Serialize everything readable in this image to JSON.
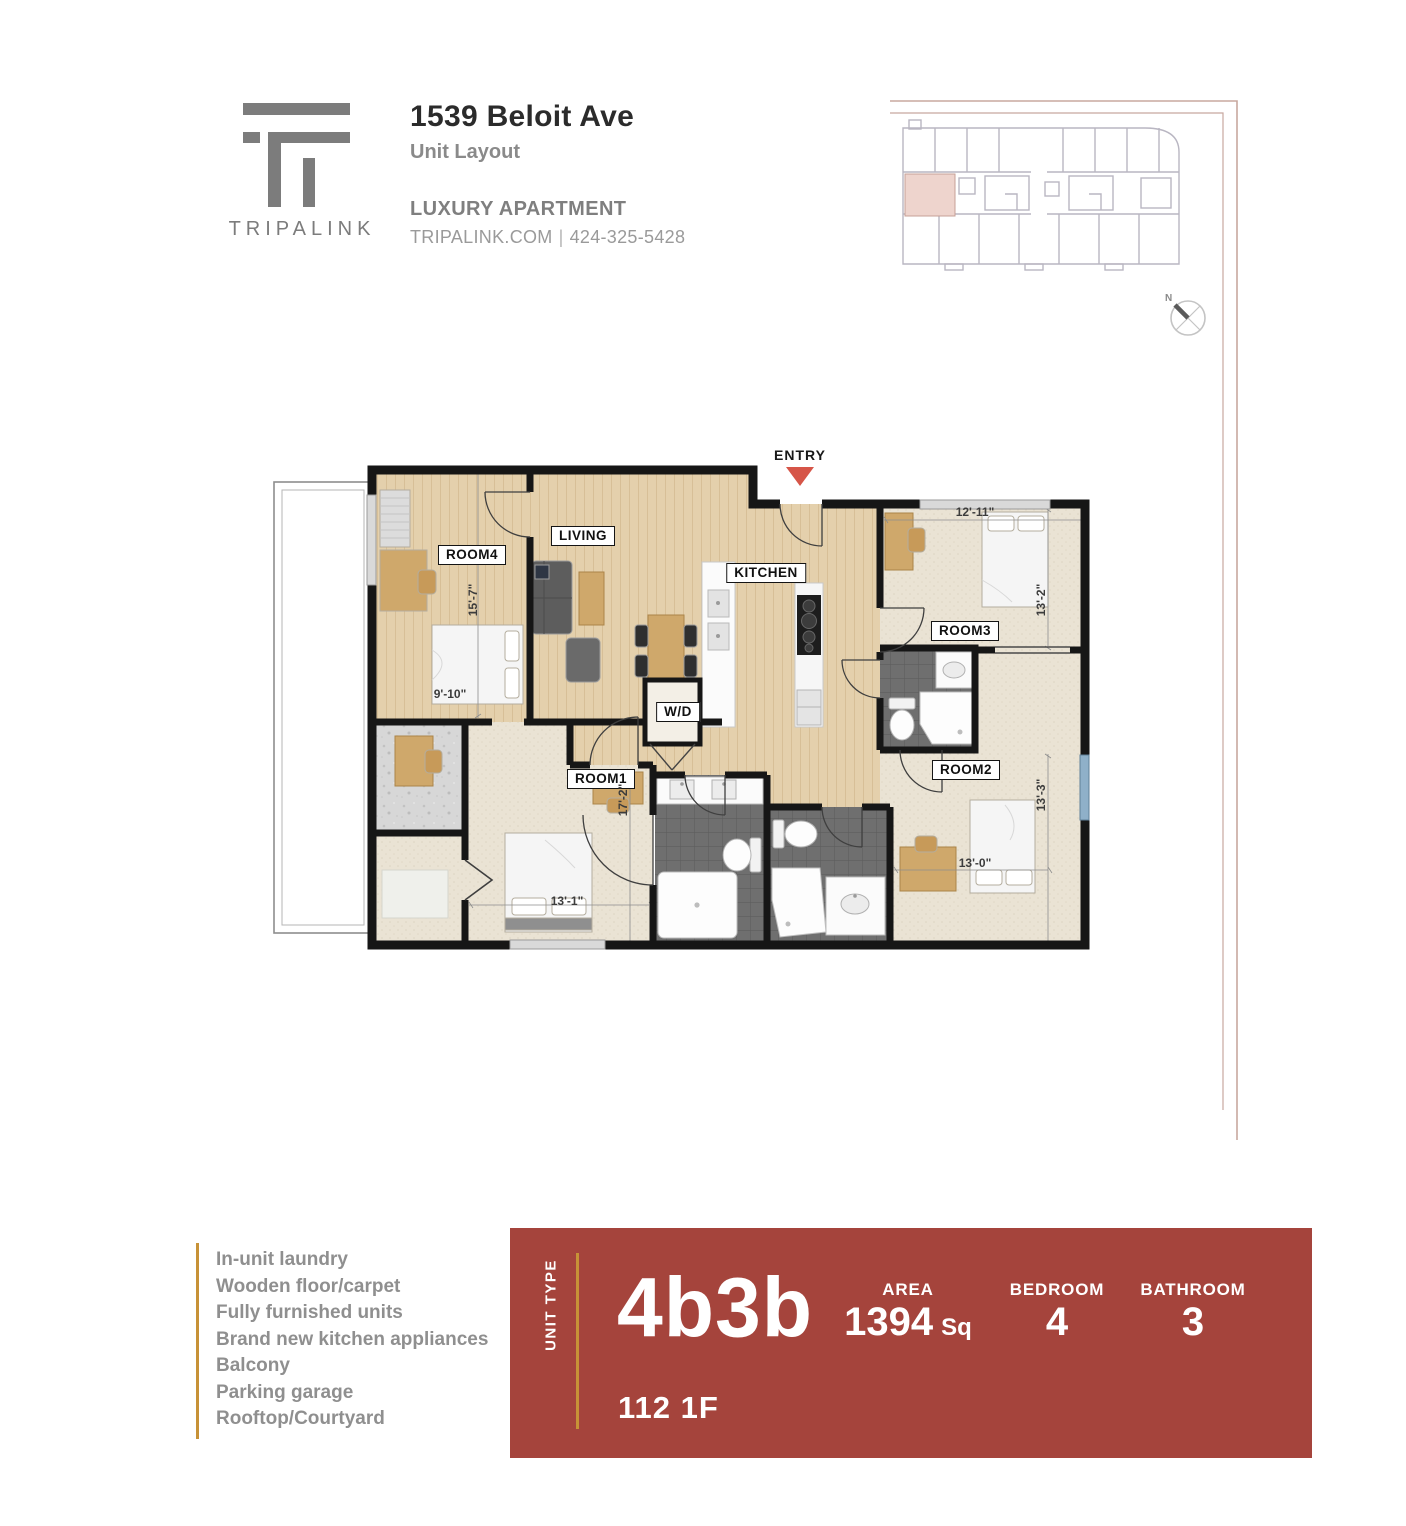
{
  "header": {
    "logo_text": "TRIPALINK",
    "address": "1539 Beloit Ave",
    "subtitle": "Unit Layout",
    "tagline": "LUXURY APARTMENT",
    "website": "TRIPALINK.COM",
    "contact_separator": "|",
    "phone": "424-325-5428"
  },
  "key_plan": {
    "north_label": "N"
  },
  "floor_plan": {
    "entry_label": "ENTRY",
    "labels": {
      "room1": "ROOM1",
      "room2": "ROOM2",
      "room3": "ROOM3",
      "room4": "ROOM4",
      "living": "LIVING",
      "kitchen": "KITCHEN",
      "washer_dryer": "W/D"
    },
    "dims": {
      "room4_v": "15'-7\"",
      "room4_h": "9'-10\"",
      "room3_h": "12'-11\"",
      "room3_v": "13'-2\"",
      "room2_v": "13'-3\"",
      "room2_h": "13'-0\"",
      "room1_v": "17'-2\"",
      "room1_h": "13'-1\""
    }
  },
  "amenities": [
    "In-unit laundry",
    "Wooden floor/carpet",
    "Fully furnished units",
    "Brand new kitchen appliances",
    "Balcony",
    "Parking garage",
    "Rooftop/Courtyard"
  ],
  "banner": {
    "unit_type_label": "UNIT TYPE",
    "unit_type": "4b3b",
    "unit_number": "112 1F",
    "stats": [
      {
        "label": "AREA",
        "value": "1394",
        "suffix": "Sq"
      },
      {
        "label": "BEDROOM",
        "value": "4",
        "suffix": ""
      },
      {
        "label": "BATHROOM",
        "value": "3",
        "suffix": ""
      }
    ]
  },
  "colors": {
    "banner_red": "#a5443c",
    "accent_gold": "#c79237",
    "entry_arrow": "#d65548",
    "highlighted_unit": "#eed4cd"
  }
}
